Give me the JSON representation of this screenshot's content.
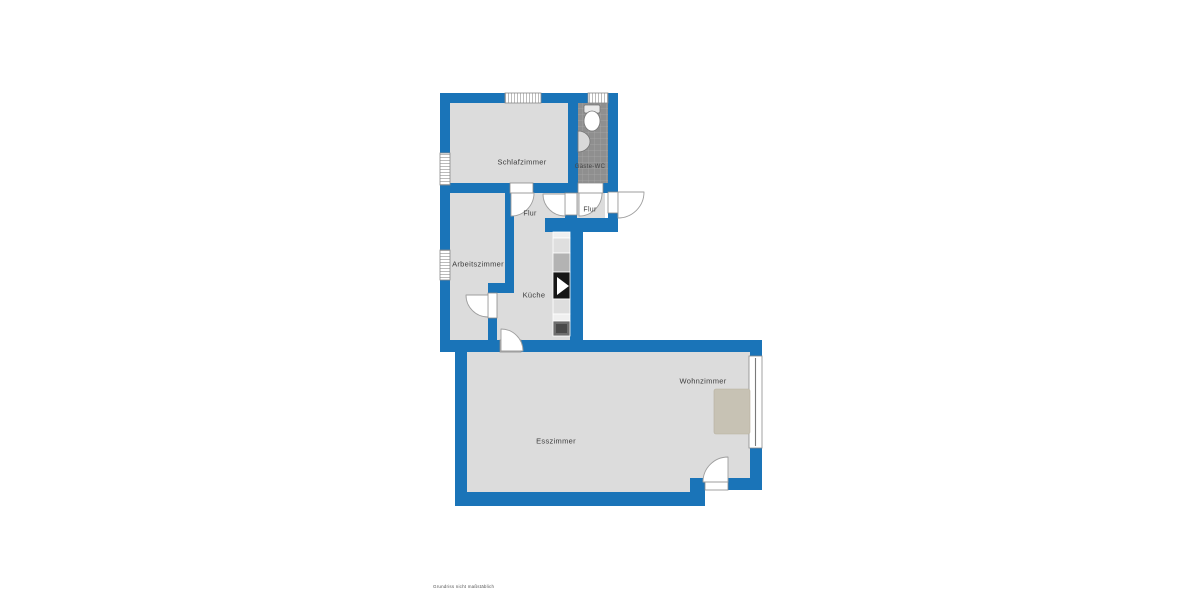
{
  "plan": {
    "rooms": {
      "schlafzimmer": {
        "label": "Schlafzimmer"
      },
      "gaeste_wc": {
        "label": "Gäste-WC"
      },
      "flur_oben": {
        "label": "Flur"
      },
      "flur_eingang": {
        "label": "Flur"
      },
      "arbeitszimmer": {
        "label": "Arbeitszimmer"
      },
      "kueche": {
        "label": "Küche"
      },
      "esszimmer": {
        "label": "Esszimmer"
      },
      "wohnzimmer": {
        "label": "Wohnzimmer"
      }
    },
    "footer_note": "Grundriss nicht maßstäblich",
    "colors": {
      "background": "#ffffff",
      "wall": "#1a74b8",
      "room_fill": "#dcdcdc",
      "wc_tile": "#8f8f8f",
      "tile_grout": "#a8a8a8",
      "rug": "#c7c2b4",
      "outline": "#8a8a8a"
    }
  }
}
